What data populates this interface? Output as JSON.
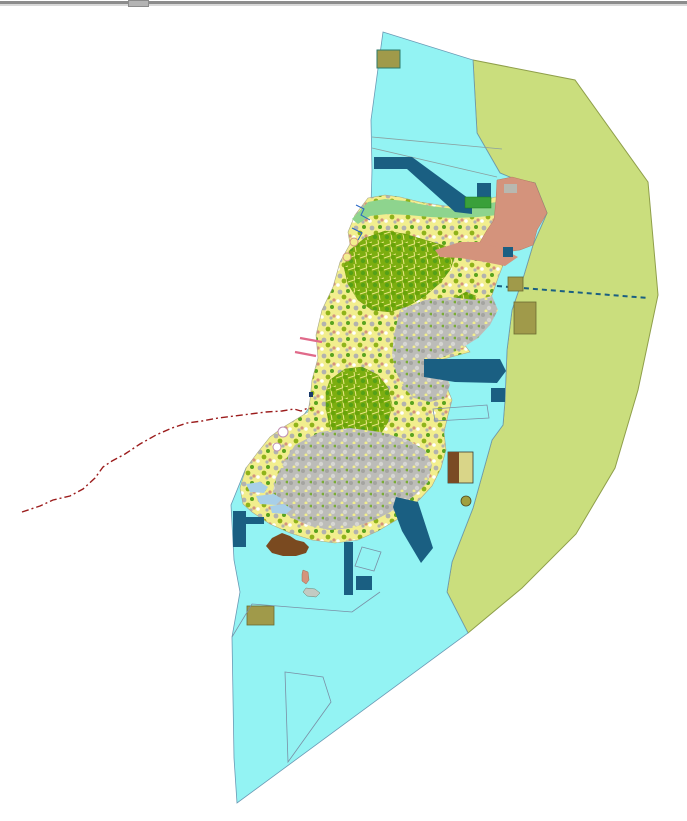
{
  "window": {
    "edge_color": "#8c8c8c",
    "edge_highlight": "#d8d8d8",
    "scroll_tab_color": "#b4b4b4",
    "background": "#ffffff"
  },
  "map": {
    "kind": "gis-land-use-map",
    "colors": {
      "water": "#93f3f3",
      "water_outline": "#6a9ab5",
      "buffer_zone": "#cade7d",
      "buffer_outline": "#8f9f4a",
      "navy_feature": "#1a5f82",
      "salmon_zone": "#d4937c",
      "coastal_green": "#8ed48e",
      "parcel_yellow": "#f2ee8e",
      "forest_green": "#7cae10",
      "urban_gray": "#bcbcb8",
      "khaki_site": "#a09a4a",
      "brown_site": "#7a4a20",
      "boundary_red": "#9b1c1c",
      "groyne_pink": "#e06a8a",
      "stream_blue": "#2565c5"
    },
    "features": [
      {
        "name": "buffer-zone",
        "type": "polygon",
        "attrs": {
          "points": "473,60 575,80 648,182 658,295 638,390 615,468 576,534 522,588 468,633 447,592 452,562 473,508 492,440 503,425 505,400 507,350 512,310 524,275 533,245 547,213 535,183 512,178 500,173 477,133",
          "fill": "#cade7d",
          "stroke": "#8f9f4a",
          "stroke-width": "1"
        }
      },
      {
        "name": "water-body",
        "type": "polygon",
        "attrs": {
          "points": "383,32 473,60 477,133 500,173 512,178 535,183 547,213 533,245 524,275 512,310 507,350 505,400 503,425 492,440 473,508 452,562 447,592 468,633 237,803 234,758 232,637 240,592 234,560 231,505 246,468 264,450 275,441 300,420 315,400 322,358 324,332 330,300 342,268 353,242 362,222 371,206 372,170 371,120",
          "fill": "#93f3f3",
          "stroke": "#6a9ab5",
          "stroke-width": "0.8"
        }
      },
      {
        "name": "water-parcel-line-1",
        "type": "polyline",
        "attrs": {
          "points": "372,137 502,149",
          "fill": "none",
          "stroke": "#8aa0a0",
          "stroke-width": "0.8"
        }
      },
      {
        "name": "water-parcel-line-2",
        "type": "polyline",
        "attrs": {
          "points": "372,148 497,177",
          "fill": "none",
          "stroke": "#8aa0a0",
          "stroke-width": "0.8"
        }
      },
      {
        "name": "island-base",
        "type": "polygon",
        "attrs": {
          "points": "368,198 385,195 400,197 420,202 445,206 465,206 480,202 495,197 508,199 514,206 515,215 512,228 510,243 505,260 498,278 492,295 480,310 468,325 458,336 470,352 440,360 436,375 448,390 452,400 448,415 444,432 446,450 441,468 432,486 420,499 410,508 398,519 378,531 358,540 335,543 312,540 290,533 270,524 252,512 243,504 240,488 246,468 258,452 270,437 282,428 295,420 308,412 310,400 312,380 318,358 316,335 322,310 333,287 340,262 350,244 348,232 355,215",
          "fill": "pattern:mosaicMix",
          "stroke": "#a8a888",
          "stroke-width": "0.6"
        }
      },
      {
        "name": "north-coastal-band",
        "type": "polygon",
        "attrs": {
          "points": "352,219 368,202 385,199 405,201 430,206 455,209 472,208 490,203 505,201 512,207 514,214 498,215 478,217 455,218 430,217 408,215 388,214 370,216 358,224",
          "fill": "#8ed48e"
        }
      },
      {
        "name": "forest-area-north",
        "type": "polygon",
        "attrs": {
          "points": "350,250 365,238 385,231 405,234 425,240 445,246 455,256 450,270 440,283 425,296 408,306 390,312 372,310 358,300 348,284 344,267",
          "fill": "pattern:forestDense",
          "stroke": "#6a9a08",
          "stroke-width": "0.5"
        }
      },
      {
        "name": "forest-area-central",
        "type": "polygon",
        "attrs": {
          "points": "330,380 345,369 362,367 378,375 388,388 392,405 388,422 378,438 364,448 350,450 338,442 330,428 326,408 326,392",
          "fill": "pattern:forestDense",
          "stroke": "#6a9a08",
          "stroke-width": "0.5"
        }
      },
      {
        "name": "forest-area-south",
        "type": "polygon",
        "attrs": {
          "points": "380,468 395,461 408,465 412,477 404,488 390,490 380,483",
          "fill": "pattern:forestDense",
          "stroke": "#6a9a08",
          "stroke-width": "0.5"
        }
      },
      {
        "name": "forest-area-east",
        "type": "polygon",
        "attrs": {
          "points": "452,300 466,292 476,296 474,308 464,316 454,312",
          "fill": "pattern:forestDense",
          "stroke": "#6a9a08",
          "stroke-width": "0.5"
        }
      },
      {
        "name": "urban-area-east",
        "type": "polygon",
        "attrs": {
          "points": "400,310 425,300 450,297 475,300 492,296 498,310 490,325 478,338 462,348 448,355 436,360 445,372 450,385 445,398 430,402 414,398 404,388 396,372 392,355 394,335",
          "fill": "pattern:urbanGray"
        }
      },
      {
        "name": "urban-area-south",
        "type": "polygon",
        "attrs": {
          "points": "295,445 320,432 350,428 380,432 408,440 425,450 432,465 428,482 415,495 398,508 375,520 352,528 330,530 310,526 292,518 278,508 272,495 276,478 284,462",
          "fill": "pattern:urbanGray"
        }
      },
      {
        "name": "salmon-zone-northeast",
        "type": "polygon",
        "attrs": {
          "points": "497,180 512,177 535,183 547,213 537,230 533,245 520,250 505,252 488,247 480,242 487,230 494,220 496,200",
          "fill": "#d4937c",
          "stroke": "#b87a60",
          "stroke-width": "0.5"
        }
      },
      {
        "name": "salmon-zone-band",
        "type": "polygon",
        "attrs": {
          "points": "435,250 460,242 480,242 505,250 518,257 505,266 485,262 460,258 440,257",
          "fill": "#d4937c"
        }
      },
      {
        "name": "salmon-zone-gray-patch",
        "type": "rect",
        "attrs": {
          "x": "504",
          "y": "184",
          "width": "13",
          "height": "9",
          "fill": "#b8b8b0"
        }
      },
      {
        "name": "navy-band-north",
        "type": "polygon",
        "attrs": {
          "points": "374,157 412,157 472,201 472,214 455,212 407,169 374,169",
          "fill": "#1a5f82"
        }
      },
      {
        "name": "navy-square-ne-1",
        "type": "rect",
        "attrs": {
          "x": "477",
          "y": "183",
          "width": "14",
          "height": "14",
          "fill": "#1a5f82"
        }
      },
      {
        "name": "green-site-ne",
        "type": "rect",
        "attrs": {
          "x": "465",
          "y": "197",
          "width": "26",
          "height": "11",
          "fill": "#3aa03a",
          "stroke": "#1a7a1a",
          "stroke-width": "0.5"
        }
      },
      {
        "name": "navy-square-east-coast",
        "type": "rect",
        "attrs": {
          "x": "503",
          "y": "247",
          "width": "10",
          "height": "10",
          "fill": "#1a5f82"
        }
      },
      {
        "name": "navy-dashed-line-east",
        "type": "polyline",
        "attrs": {
          "points": "497,286 648,298",
          "fill": "none",
          "stroke": "#1a5f82",
          "stroke-width": "2",
          "stroke-dasharray": "5 4"
        }
      },
      {
        "name": "navy-band-east",
        "type": "polygon",
        "attrs": {
          "points": "424,359 500,359 506,371 497,383 455,382 424,377",
          "fill": "#1a5f82"
        }
      },
      {
        "name": "navy-square-east-2",
        "type": "rect",
        "attrs": {
          "x": "491",
          "y": "388",
          "width": "14",
          "height": "14",
          "fill": "#1a5f82"
        }
      },
      {
        "name": "navy-band-southeast",
        "type": "polygon",
        "attrs": {
          "points": "396,497 418,502 433,548 421,563 402,531 393,507",
          "fill": "#1a5f82"
        }
      },
      {
        "name": "navy-strip-south",
        "type": "rect",
        "attrs": {
          "x": "344",
          "y": "542",
          "width": "9",
          "height": "53",
          "fill": "#1a5f82"
        }
      },
      {
        "name": "navy-square-south",
        "type": "rect",
        "attrs": {
          "x": "356",
          "y": "576",
          "width": "16",
          "height": "14",
          "fill": "#1a5f82"
        }
      },
      {
        "name": "navy-tshape-west",
        "type": "polygon",
        "attrs": {
          "points": "233,511 246,511 246,517 264,517 264,524 246,524 246,547 233,547",
          "fill": "#1a5f82"
        }
      },
      {
        "name": "coast-mark-west",
        "type": "rect",
        "attrs": {
          "x": "309",
          "y": "392",
          "width": "4",
          "height": "5",
          "fill": "#1a3a6a"
        }
      },
      {
        "name": "khaki-site-north",
        "type": "rect",
        "attrs": {
          "x": "377",
          "y": "50",
          "width": "23",
          "height": "18",
          "fill": "#a09a4a",
          "stroke": "#2e7a6a",
          "stroke-width": "1"
        }
      },
      {
        "name": "khaki-site-east-small",
        "type": "rect",
        "attrs": {
          "x": "508",
          "y": "277",
          "width": "15",
          "height": "14",
          "fill": "#a09a4a",
          "stroke": "#6a6a30",
          "stroke-width": "0.8"
        }
      },
      {
        "name": "khaki-site-east-large",
        "type": "rect",
        "attrs": {
          "x": "514",
          "y": "302",
          "width": "22",
          "height": "32",
          "fill": "#a09a4a",
          "stroke": "#6a6a30",
          "stroke-width": "0.8"
        }
      },
      {
        "name": "khaki-site-southwest",
        "type": "rect",
        "attrs": {
          "x": "247",
          "y": "606",
          "width": "27",
          "height": "19",
          "fill": "#a09a4a",
          "stroke": "#6a6a30",
          "stroke-width": "0.8"
        }
      },
      {
        "name": "khaki-islet-southeast",
        "type": "circle",
        "attrs": {
          "cx": "466",
          "cy": "501",
          "r": "5",
          "fill": "#a0a040",
          "stroke": "#504a20",
          "stroke-width": "0.8"
        }
      },
      {
        "name": "site-rect-two-tone",
        "type": "rect",
        "attrs": {
          "x": "448",
          "y": "452",
          "width": "25",
          "height": "31",
          "fill": "#d9d588",
          "stroke": "#3a3a30",
          "stroke-width": "0.8"
        }
      },
      {
        "name": "site-rect-two-tone-brown",
        "type": "rect",
        "attrs": {
          "x": "448",
          "y": "452",
          "width": "11",
          "height": "31",
          "fill": "#7a4a24"
        }
      },
      {
        "name": "brown-area-southwest",
        "type": "polygon",
        "attrs": {
          "points": "266,546 272,538 282,533 290,536 296,540 304,542 309,547 306,553 296,556 283,556 272,553",
          "fill": "#7a4a20"
        }
      },
      {
        "name": "islet-salmon",
        "type": "polygon",
        "attrs": {
          "points": "303,570 308,572 309,580 306,584 302,581 302,574",
          "fill": "#d4937c",
          "stroke": "#a06a50",
          "stroke-width": "0.5"
        }
      },
      {
        "name": "islet-gray",
        "type": "polygon",
        "attrs": {
          "points": "306,588 315,589 320,593 316,597 307,596 303,592",
          "fill": "#c2cac2",
          "stroke": "#708070",
          "stroke-width": "0.5"
        }
      },
      {
        "name": "parcel-outline-rotated-square",
        "type": "polygon",
        "attrs": {
          "points": "362,547 381,552 374,571 355,566",
          "fill": "none",
          "stroke": "#7a8fa5",
          "stroke-width": "0.8"
        }
      },
      {
        "name": "parcel-outline-east",
        "type": "polygon",
        "attrs": {
          "points": "433,409 487,405 489,418 435,421",
          "fill": "none",
          "stroke": "#7a8fa5",
          "stroke-width": "0.8"
        }
      },
      {
        "name": "parcel-outline-south",
        "type": "polygon",
        "attrs": {
          "points": "285,672 323,677 331,702 288,762",
          "fill": "none",
          "stroke": "#7a8fa5",
          "stroke-width": "0.8"
        }
      },
      {
        "name": "parcel-line-south",
        "type": "polyline",
        "attrs": {
          "points": "232,637 252,604 352,612 380,592",
          "fill": "none",
          "stroke": "#7a8fa5",
          "stroke-width": "0.8"
        }
      },
      {
        "name": "shallow-water-patch-1",
        "type": "polygon",
        "attrs": {
          "points": "246,484 260,482 268,487 264,493 250,492",
          "fill": "#a8cfe8"
        }
      },
      {
        "name": "shallow-water-patch-2",
        "type": "polygon",
        "attrs": {
          "points": "256,496 274,494 282,499 276,505 260,504",
          "fill": "#a8cfe8"
        }
      },
      {
        "name": "shallow-water-patch-3",
        "type": "polygon",
        "attrs": {
          "points": "270,506 284,504 292,509 286,514 272,513",
          "fill": "#a8cfe8"
        }
      },
      {
        "name": "groyne-pink-1",
        "type": "polyline",
        "attrs": {
          "points": "300,338 322,342",
          "fill": "none",
          "stroke": "#e06a8a",
          "stroke-width": "2.4"
        }
      },
      {
        "name": "groyne-pink-2",
        "type": "polyline",
        "attrs": {
          "points": "295,352 316,356",
          "fill": "none",
          "stroke": "#e06a8a",
          "stroke-width": "2.4"
        }
      },
      {
        "name": "stream-northwest-1",
        "type": "polyline",
        "attrs": {
          "points": "356,205 364,209 361,215 370,220",
          "fill": "none",
          "stroke": "#2565c5",
          "stroke-width": "1"
        }
      },
      {
        "name": "stream-northwest-2",
        "type": "polyline",
        "attrs": {
          "points": "352,228 362,233 358,240",
          "fill": "none",
          "stroke": "#2565c5",
          "stroke-width": "1"
        }
      },
      {
        "name": "coast-ring-1",
        "type": "circle",
        "attrs": {
          "cx": "354",
          "cy": "242",
          "r": "4",
          "fill": "#f2ee8e",
          "stroke": "#d4937c",
          "stroke-width": "1"
        }
      },
      {
        "name": "coast-ring-2",
        "type": "circle",
        "attrs": {
          "cx": "347",
          "cy": "257",
          "r": "4",
          "fill": "#f2ee8e",
          "stroke": "#d4937c",
          "stroke-width": "1"
        }
      },
      {
        "name": "coast-ring-3",
        "type": "circle",
        "attrs": {
          "cx": "283",
          "cy": "432",
          "r": "5",
          "fill": "#ffffff",
          "stroke": "#c090b0",
          "stroke-width": "1"
        }
      },
      {
        "name": "coast-ring-4",
        "type": "circle",
        "attrs": {
          "cx": "277",
          "cy": "447",
          "r": "4",
          "fill": "#ffffff",
          "stroke": "#c090b0",
          "stroke-width": "1"
        }
      },
      {
        "name": "red-dashed-boundary",
        "type": "polyline",
        "attrs": {
          "points": "22,512 40,506 53,500 70,496 83,489 95,478 103,467 112,461 125,454 140,444 156,435 172,428 187,423 202,421 218,418 234,416 250,414 266,412 282,411 294,409 301,411 308,408 312,409",
          "fill": "none",
          "stroke": "#9b1c1c",
          "stroke-width": "1.4",
          "stroke-dasharray": "7 3 2 3"
        }
      }
    ]
  }
}
